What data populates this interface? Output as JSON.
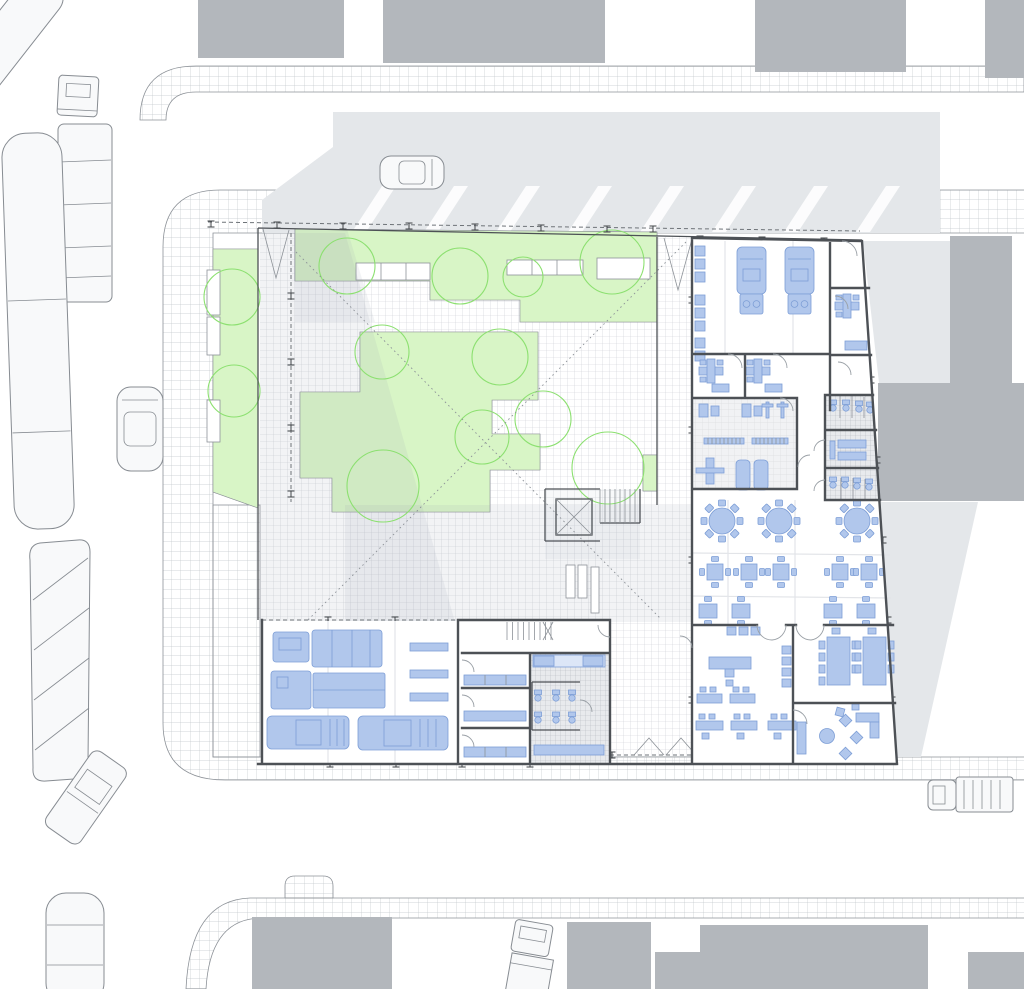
{
  "meta": {
    "description": "Architectural ground-floor site plan: emergency-services community building with planted courtyard, ambulance bays, gym, locker rooms, dining hall, offices, vehicle carport, surrounded by streets, sidewalks, parked vehicles and neighboring building masses. No text labels are rendered on the drawing.",
    "visible_text": "none"
  },
  "colors": {
    "paper": "#ffffff",
    "line": "#8d9298",
    "wall": "#4d5156",
    "dash": "#6e7378",
    "mass": "#b3b7bc",
    "shadow": "#9aa5b3",
    "extshadow": "#e4e7ea",
    "sidewalk_line": "#c3c7cc",
    "court_line": "#c9cdd2",
    "wet_bg": "#e8eaed",
    "wet_line": "#b6bbc0",
    "gym_bg": "#f1f2f4",
    "gym_line": "#dcdee1",
    "green": "#d8f5c6",
    "green_edge": "#8ce070",
    "green_dot": "#5fd93f",
    "blue": "#b1c7ec",
    "blue_edge": "#7d9ed6",
    "blue_light": "#dce6f7",
    "vehicle": "#f8f9fa"
  },
  "site": {
    "building_rooms": [
      "ambulance-garage-bay",
      "duty-offices",
      "fitness-room",
      "locker-showers",
      "dining-hall",
      "classroom-office",
      "meeting-room",
      "lounge",
      "vehicle-carport",
      "changing-rooms",
      "sanitary-core",
      "stair-elevator-core"
    ],
    "site_features": [
      "planted-courtyard",
      "tree-canopies",
      "canopy-columns",
      "paved-plaza",
      "benches",
      "sight-line-diagonals",
      "sidewalk-grid-paving",
      "streets",
      "striped-traffic-island",
      "neighboring-building-masses",
      "cast-shadows"
    ],
    "street_vehicles": [
      "semi-trailer-truck",
      "articulated-bus",
      "city-bus",
      "sedan-car",
      "station-wagon",
      "pickup-truck",
      "box-truck",
      "delivery-truck"
    ],
    "garage_vehicles": [
      "semi-truck",
      "fire-truck",
      "pickup-truck",
      "pickup-truck"
    ],
    "counts": {
      "trees": 12,
      "round_tables_8_seats": 3,
      "square_tables_4_seats": 5,
      "square_tables_2_seats": 4,
      "meeting_tables": 2,
      "ambulances": 2
    }
  }
}
